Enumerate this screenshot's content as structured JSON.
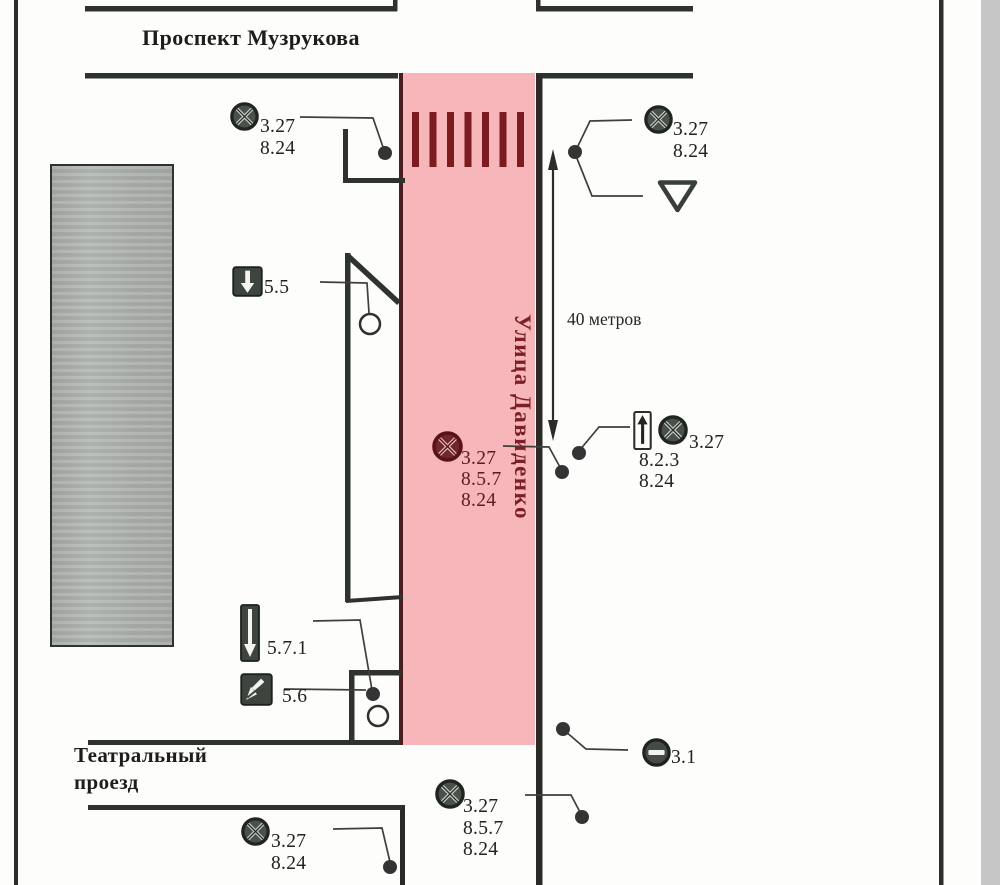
{
  "streets": {
    "avenue_top": "Проспект Музрукова",
    "street_vertical": "Улица Давиденко",
    "passage_line1": "Театральный",
    "passage_line2": "проезд"
  },
  "dimension": {
    "length_label": "40 метров"
  },
  "sign_labels": {
    "top_left": [
      "3.27",
      "8.24"
    ],
    "top_right": [
      "3.27",
      "8.24"
    ],
    "one_way": [
      "5.5"
    ],
    "mid_zone": [
      "3.27",
      "8.5.7",
      "8.24"
    ],
    "mid_right_plate": [
      "8.2.3",
      "8.24"
    ],
    "mid_right_circle": [
      "3.27"
    ],
    "exit_one_way": [
      "5.7.1"
    ],
    "end_one_way": [
      "5.6"
    ],
    "no_entry": [
      "3.1"
    ],
    "bottom_mid": [
      "3.27",
      "8.5.7",
      "8.24"
    ],
    "bottom_left": [
      "3.27",
      "8.24"
    ]
  },
  "icons": {
    "no_stopping": "no-stopping-sign",
    "give_way": "give-way-sign",
    "one_way_down": "one-way-traffic-sign",
    "exit_to_one_way": "one-way-exit-sign",
    "end_one_way": "end-of-one-way-sign",
    "direction_plate": "direction-arrow-plate",
    "no_entry": "no-entry-sign",
    "crossing": "pedestrian-crossing-marking"
  },
  "colors": {
    "zone_pink": "#f7b6ba",
    "marking_dark_red": "#7a1e24",
    "road_line": "#2e332e",
    "sign_dark": "#414841",
    "building_gray": "#b0b4b0",
    "scan_strip_gray": "#c6c6c6"
  }
}
